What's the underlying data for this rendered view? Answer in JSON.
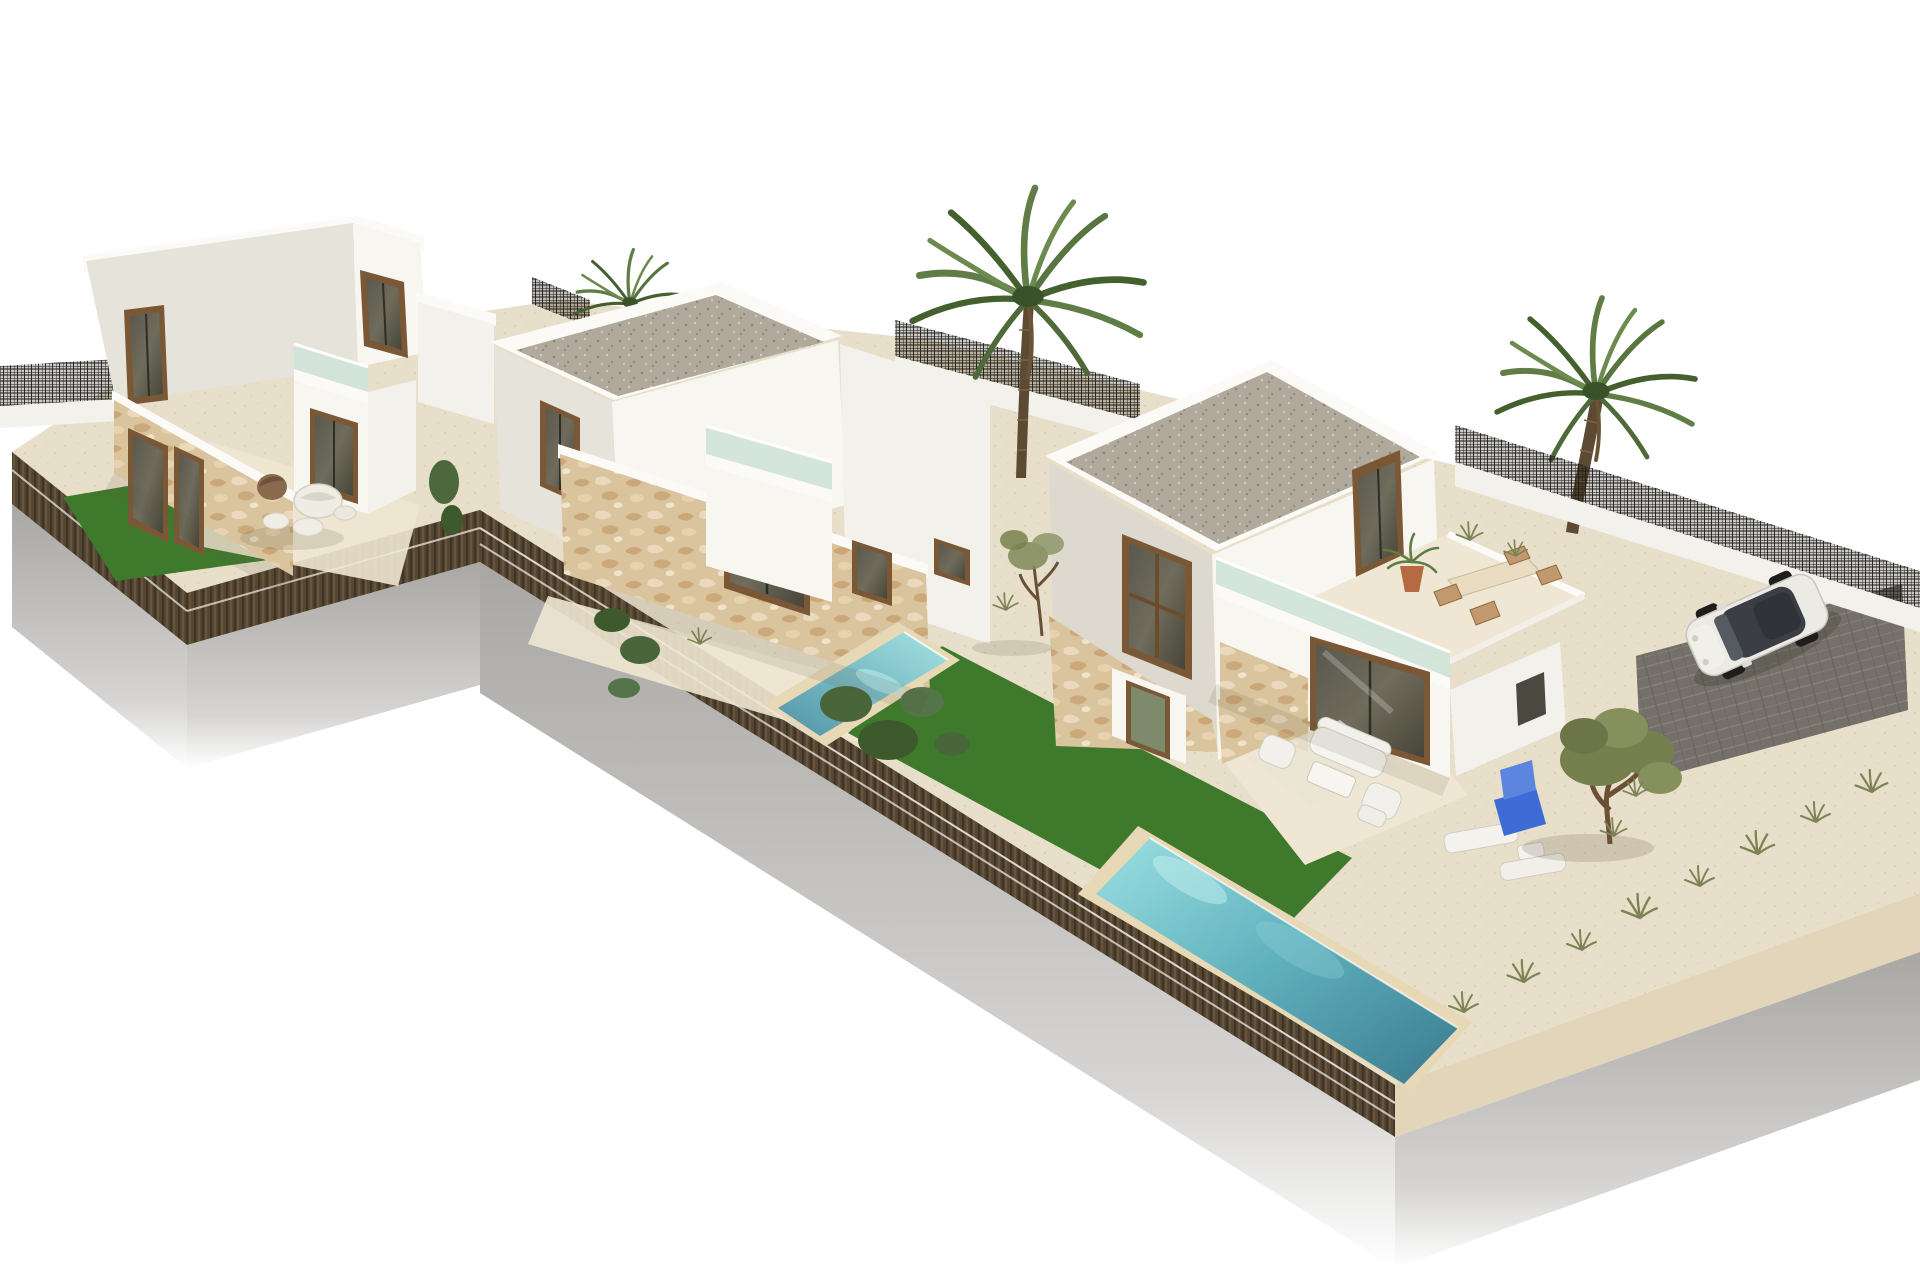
{
  "scene": {
    "type": "3d-architectural-render",
    "description": "Aerial 3D visualization of three modern white two-storey new-build villas on a raised L-shaped plot, each with flat gravel roof, stone-clad ground floor, glass-balustrade roof terraces, private lawns and pools; gravel landscaped yard with sun loungers, olive tree, three palm trees, dark mesh boundary fences and a white SUV parked on a dark paver driveway; pure white background",
    "villa_count": 3,
    "pool_count": 2,
    "palm_count": 3
  },
  "palette": {
    "sky": "#ffffff",
    "sand": "#e8dfca",
    "sand_light": "#efe7d3",
    "lawn": "#3f7a2c",
    "pool_coping": "#e7d8b6",
    "hedge": "#564734",
    "base_gray": "#aeacaa",
    "wall_bright": "#f8f6f0",
    "wall_shadow": "#e6e3da",
    "wall_dim": "#ddd9cf",
    "wall_white": "#f3f1ec",
    "parapet": "#fbfaf7",
    "roof_gravel": "#b1aa9c",
    "stone": "#d9c49e",
    "stone_light": "#e2d5ba",
    "frame_brown": "#7a5836",
    "glass_dark": "#4b493f",
    "balustrade_teal": "#cfe3d8",
    "fence_dark": "#2c261e",
    "driveway": "#75716a",
    "palm_leaf": "#5f7d45",
    "palm_leaf_dark": "#44602f",
    "palm_trunk": "#5d4a33",
    "olive_leaf": "#76804f",
    "green_door": "#7d8a6b",
    "car_body": "#eceae4",
    "car_glass": "#3b3f45",
    "lounger_blue": "#3d6cd6",
    "furniture_white": "#f2f0ea"
  },
  "objects": {
    "plot": {
      "shape": "raised L-shaped platform",
      "edge": "dark hedge band with two white cable rails",
      "base": "grey concrete fading to white"
    },
    "villas": [
      {
        "id": "villa-1",
        "position": "left",
        "storeys": 2,
        "roof": "flat gravel",
        "features": [
          "stone-clad garden wing",
          "annex with glass balustrade terrace",
          "pebble shaped garden seats",
          "private lawn"
        ]
      },
      {
        "id": "villa-2",
        "position": "center",
        "storeys": 2,
        "roof": "flat gravel",
        "features": [
          "stone wing with sliding door",
          "annex with glass balustrade",
          "narrow infinity pool",
          "terrace"
        ]
      },
      {
        "id": "villa-3",
        "position": "right",
        "storeys": 2,
        "roof": "flat gravel",
        "features": [
          "roof terrace with dining set and potted palm",
          "patio lounge set",
          "large pool",
          "lawn strip",
          "gravel garden",
          "driveway with parked car"
        ]
      }
    ],
    "pools": [
      {
        "id": "pool-villa-2",
        "style": "narrow infinity pool at plot edge",
        "water": "turquoise to deep teal"
      },
      {
        "id": "pool-villa-3",
        "style": "long rectangular pool with beige coping",
        "water": "turquoise to deep teal"
      }
    ],
    "palm_trees": [
      {
        "id": "palm-left",
        "size": "small",
        "location": "behind center villa"
      },
      {
        "id": "palm-center",
        "size": "tall",
        "location": "behind right villa"
      },
      {
        "id": "palm-right",
        "size": "tall",
        "location": "right boundary"
      }
    ],
    "olive_trees": [
      {
        "id": "olive-main",
        "location": "gravel yard right"
      },
      {
        "id": "sapling",
        "location": "between center and right villa"
      }
    ],
    "car": {
      "type": "white SUV",
      "roof": "dark glass",
      "location": "dark paver driveway, top right"
    },
    "furniture": {
      "patio_lounge": [
        "white sofa",
        "2 armchairs",
        "coffee table",
        "stool",
        "rug"
      ],
      "roof_terrace": [
        "dining table",
        "4 wicker chairs",
        "potted palm"
      ],
      "sunloungers": [
        "blue lounger",
        "2 white loungers",
        "side table"
      ],
      "garden_seats": [
        "brown egg chair",
        "white shell chair",
        "white pebble stools"
      ]
    },
    "fences": {
      "style": "dark metal mesh panels on low white walls",
      "segments": 4
    }
  }
}
